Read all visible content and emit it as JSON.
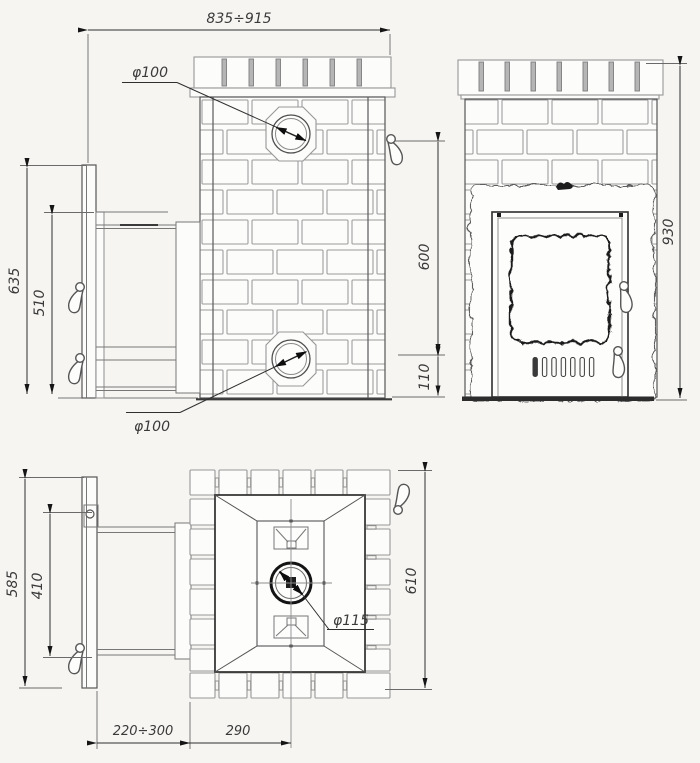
{
  "side_view": {
    "total_width": "835÷915",
    "top_chimney_diameter": "φ100",
    "rear_chimney_diameter": "φ100",
    "screen_height": "635",
    "portal_height": "510",
    "top_outlet_height": "600",
    "rear_outlet_height": "110"
  },
  "front_view": {
    "total_height": "930"
  },
  "plan_view": {
    "screen_width": "585",
    "portal_width": "410",
    "body_depth": "610",
    "chimney_diameter": "φ115",
    "tunnel_length": "220÷300",
    "chimney_offset": "290"
  },
  "colors": {
    "background": "#f6f5f2",
    "outline": "#4a4a4a",
    "brick_outline": "#949494",
    "accent_dark": "#1d1d1d",
    "dimension_text": "#3a3a3a"
  }
}
